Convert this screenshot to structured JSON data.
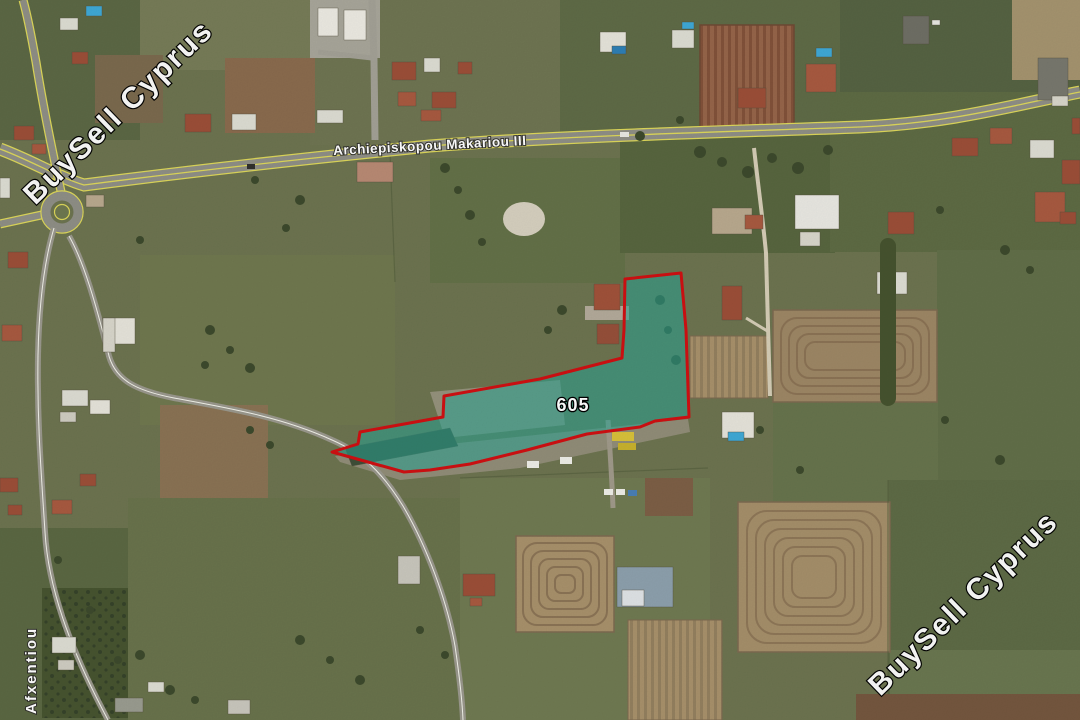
{
  "map": {
    "parcel": {
      "number": "605",
      "outline_color": "#cf1012",
      "fill_color": "rgba(40,166,150,0.55)"
    },
    "roads": {
      "main_road_label": "Archiepiskopou Makariou III",
      "side_road_label": "Afxentiou",
      "line_color": "#ddd75a"
    },
    "watermark": {
      "text": "BuySell Cyprus",
      "color": "#ffffff"
    }
  }
}
